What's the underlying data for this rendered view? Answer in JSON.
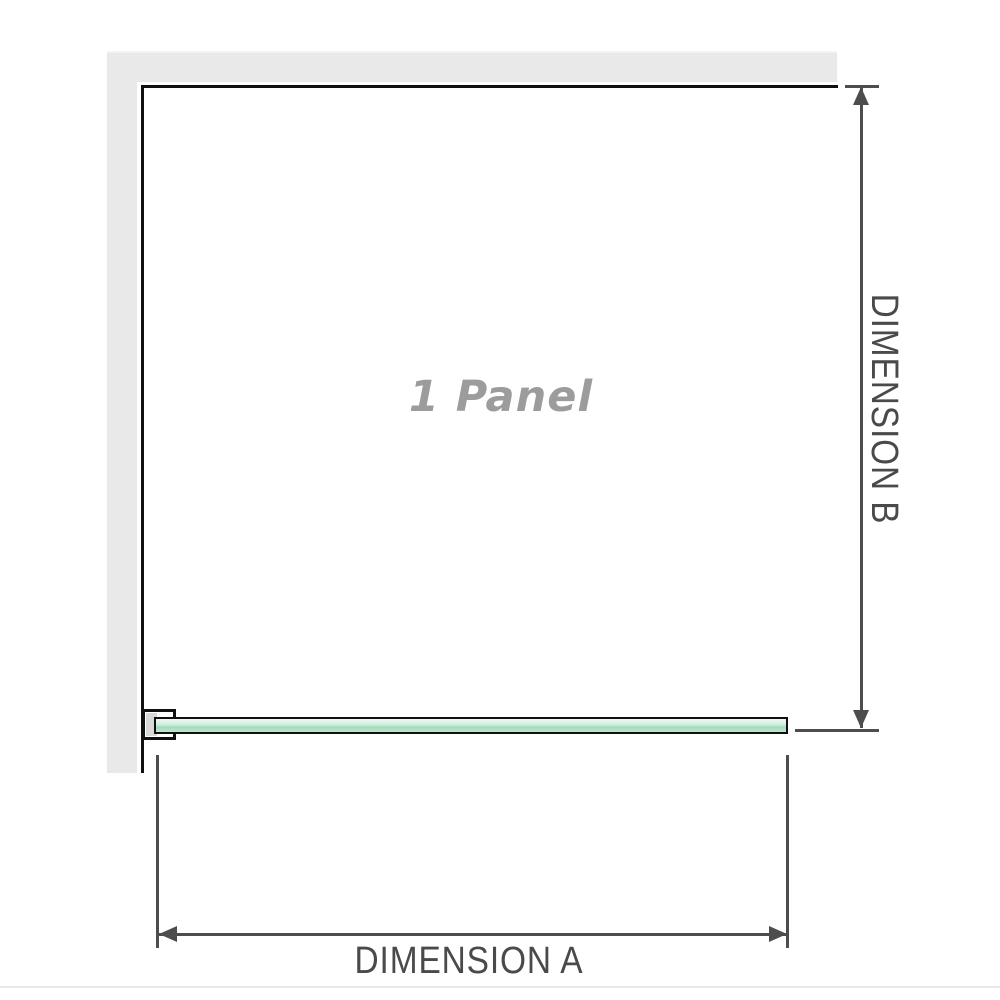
{
  "diagram": {
    "title": "1 Panel",
    "panel_count": "1",
    "dimension_a": {
      "label": "DIMENSION A"
    },
    "dimension_b": {
      "label": "DIMENSION B"
    }
  },
  "colors": {
    "wall_gray": "#e9e9e9",
    "outline_black": "#101010",
    "dimension_gray": "#4d4d4d",
    "glass_green_light": "#ddf1e7",
    "glass_green_dark": "#a4dbbb",
    "title_gray": "#9c9c9c",
    "divider_gray": "#ece9e7"
  },
  "icons": {
    "arrow_up": "dimension-arrow-up",
    "arrow_down": "dimension-arrow-down",
    "arrow_left": "dimension-arrow-left",
    "arrow_right": "dimension-arrow-right"
  }
}
